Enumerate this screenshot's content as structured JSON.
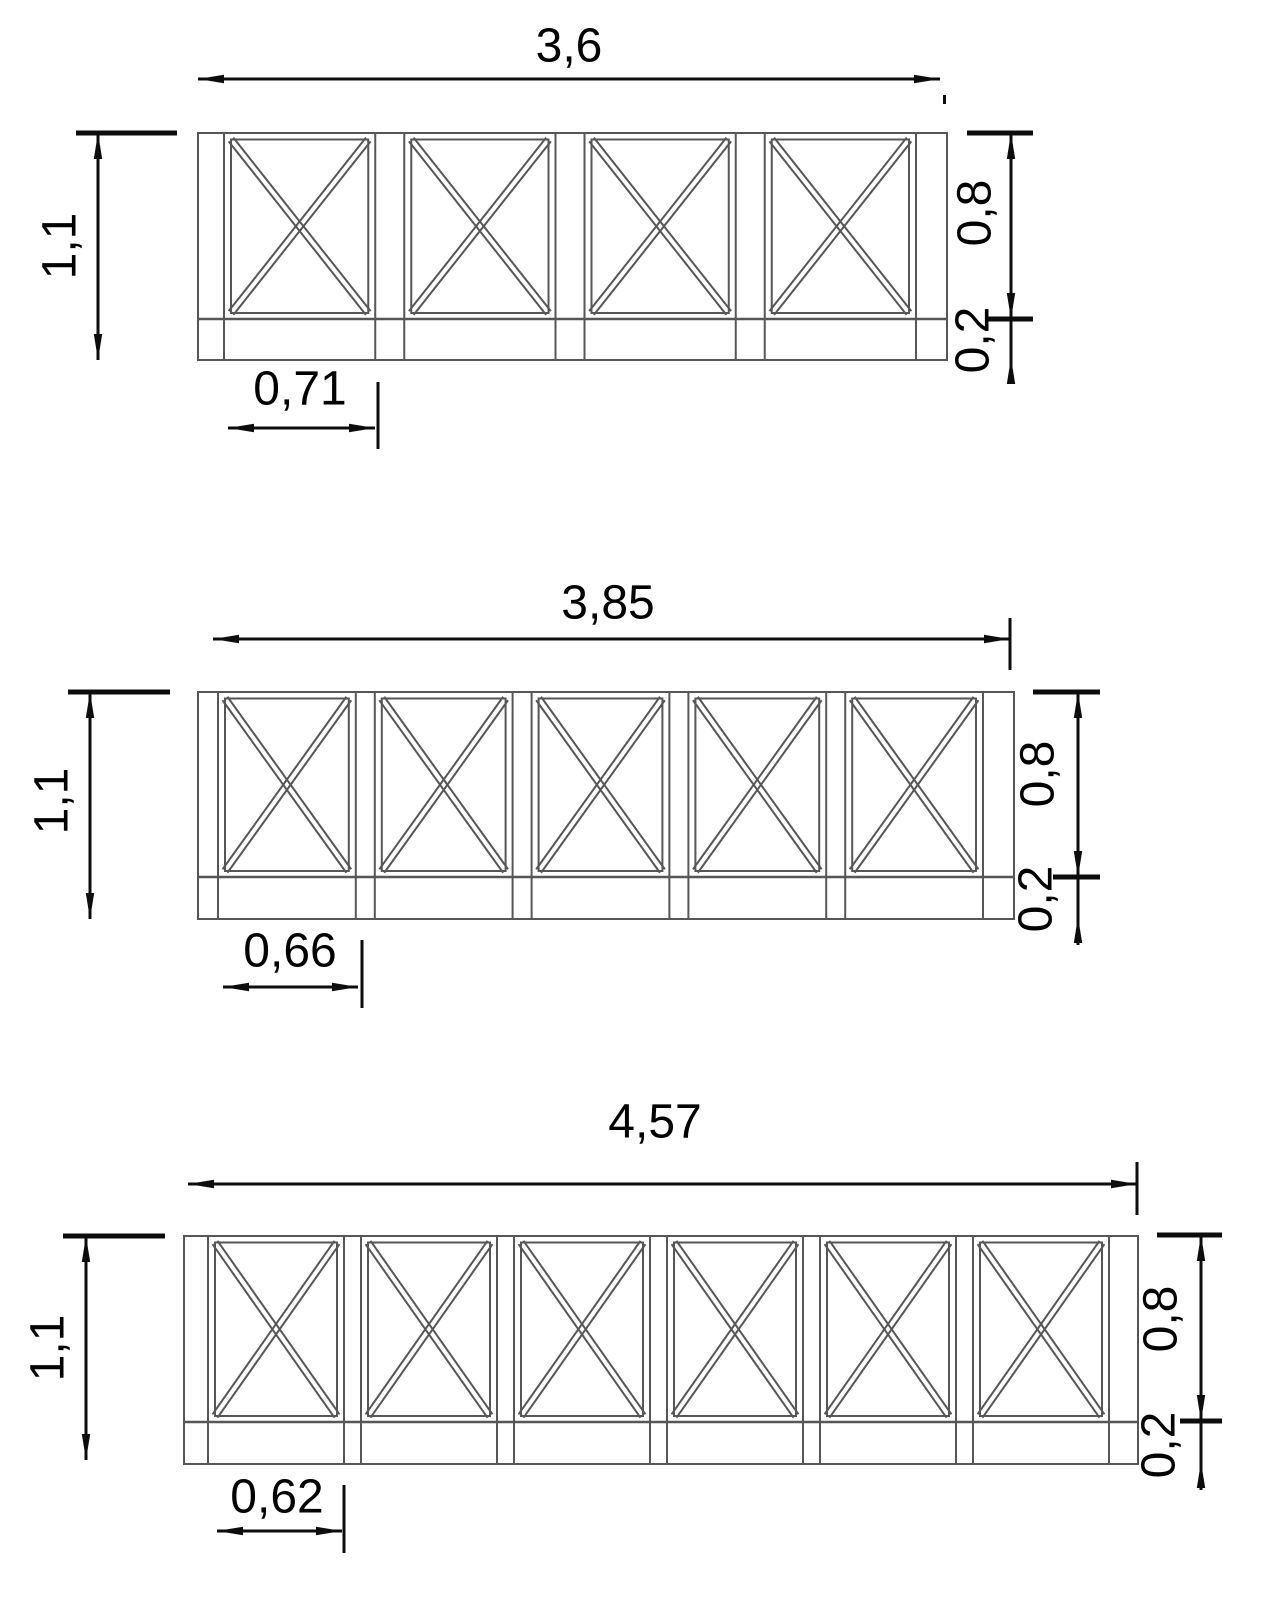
{
  "page": {
    "background": "#ffffff",
    "structure_color": "#565656",
    "dim_color": "#0d0d0d",
    "description": "Three railing elevation drawings with X-braced panels and dimensions"
  },
  "drawings": [
    {
      "id": "top",
      "panel_count": 4,
      "labels": {
        "total_width": "3,6",
        "total_height": "1,1",
        "panel_height": "0,8",
        "base_height": "0,2",
        "panel_width": "0,71"
      },
      "structure": {
        "frame": [
          198,
          133,
          947,
          360
        ],
        "rail_y": 319,
        "vlines": [
          198,
          224,
          375.25,
          404.25,
          555.5,
          584.5,
          735.75,
          764.75,
          916,
          947
        ],
        "panels": [
          [
            224,
            375.25
          ],
          [
            404.25,
            555.5
          ],
          [
            584.5,
            735.75
          ],
          [
            764.75,
            916
          ]
        ],
        "inset": {
          "side": 7,
          "top": 6.5,
          "bottom": 6
        },
        "brace_gap": 3
      },
      "dims": {
        "lines": [
          [
            198,
            79,
            940,
            79
          ],
          [
            98,
            133,
            98,
            360
          ],
          [
            1011,
            133,
            1011,
            383
          ],
          [
            228,
            428,
            375,
            428
          ]
        ],
        "ticks": [
          [
            76,
            133,
            177,
            133
          ],
          [
            967,
            133,
            1033,
            133
          ],
          [
            985,
            319,
            1033,
            319
          ]
        ],
        "ext": [
          [
            378,
            382,
            378,
            449
          ]
        ],
        "arrows": [
          [
            198,
            79,
            "left"
          ],
          [
            940,
            79,
            "right"
          ],
          [
            98,
            133,
            "up"
          ],
          [
            98,
            360,
            "down"
          ],
          [
            1011,
            133,
            "up"
          ],
          [
            1011,
            319,
            "down"
          ],
          [
            1011,
            358,
            "up"
          ],
          [
            228,
            428,
            "left"
          ],
          [
            375,
            428,
            "right"
          ]
        ],
        "dashes": [
          [
            943,
            95,
            3,
            9
          ]
        ]
      }
    },
    {
      "id": "middle",
      "panel_count": 5,
      "labels": {
        "total_width": "3,85",
        "total_height": "1,1",
        "panel_height": "0,8",
        "base_height": "0,2",
        "panel_width": "0,66"
      },
      "structure": {
        "frame": [
          198,
          692,
          1014,
          919
        ],
        "rail_y": 877,
        "vlines": [
          198,
          218,
          355.8,
          374.8,
          512.6,
          531.6,
          669.4,
          688.4,
          826.2,
          845.2,
          983,
          1014
        ],
        "panels": [
          [
            218,
            355.8
          ],
          [
            374.8,
            512.6
          ],
          [
            531.6,
            669.4
          ],
          [
            688.4,
            826.2
          ],
          [
            845.2,
            983
          ]
        ],
        "inset": {
          "side": 7,
          "top": 6.5,
          "bottom": 6
        },
        "brace_gap": 3
      },
      "dims": {
        "lines": [
          [
            213,
            639,
            1010,
            639
          ],
          [
            90,
            692,
            90,
            919
          ],
          [
            1078,
            692,
            1078,
            945
          ],
          [
            223,
            987,
            358,
            987
          ]
        ],
        "ticks": [
          [
            68,
            692,
            170,
            692
          ],
          [
            1033,
            692,
            1100,
            692
          ],
          [
            1053,
            877,
            1100,
            877
          ]
        ],
        "ext": [
          [
            1010,
            618,
            1010,
            670
          ],
          [
            362,
            940,
            362,
            1008
          ]
        ],
        "arrows": [
          [
            213,
            639,
            "left"
          ],
          [
            1010,
            639,
            "right"
          ],
          [
            90,
            692,
            "up"
          ],
          [
            90,
            919,
            "down"
          ],
          [
            1078,
            692,
            "up"
          ],
          [
            1078,
            877,
            "down"
          ],
          [
            1078,
            917,
            "up"
          ],
          [
            223,
            987,
            "left"
          ],
          [
            358,
            987,
            "right"
          ]
        ],
        "dashes": []
      }
    },
    {
      "id": "bottom",
      "panel_count": 6,
      "labels": {
        "total_width": "4,57",
        "total_height": "1,1",
        "panel_height": "0,8",
        "base_height": "0,2",
        "panel_width": "0,62"
      },
      "structure": {
        "frame": [
          184,
          1236,
          1138,
          1464
        ],
        "rail_y": 1422,
        "vlines": [
          184,
          208,
          344,
          361,
          497,
          514,
          650,
          667,
          803,
          820,
          956,
          973,
          1109,
          1138
        ],
        "panels": [
          [
            208,
            344
          ],
          [
            361,
            497
          ],
          [
            514,
            650
          ],
          [
            667,
            803
          ],
          [
            820,
            956
          ],
          [
            973,
            1109
          ]
        ],
        "inset": {
          "side": 7,
          "top": 6.5,
          "bottom": 6
        },
        "brace_gap": 3
      },
      "dims": {
        "lines": [
          [
            188,
            1184,
            1137,
            1184
          ],
          [
            86,
            1236,
            86,
            1460
          ],
          [
            1201,
            1235,
            1201,
            1490
          ],
          [
            217,
            1531,
            342,
            1531
          ]
        ],
        "ticks": [
          [
            63,
            1236,
            165,
            1236
          ],
          [
            1157,
            1235,
            1222,
            1235
          ],
          [
            1180,
            1421,
            1222,
            1421
          ]
        ],
        "ext": [
          [
            1137,
            1162,
            1137,
            1215
          ],
          [
            344,
            1485,
            344,
            1553
          ]
        ],
        "arrows": [
          [
            188,
            1184,
            "left"
          ],
          [
            1137,
            1184,
            "right"
          ],
          [
            86,
            1236,
            "up"
          ],
          [
            86,
            1460,
            "down"
          ],
          [
            1201,
            1235,
            "up"
          ],
          [
            1201,
            1421,
            "down"
          ],
          [
            1201,
            1462,
            "up"
          ],
          [
            217,
            1531,
            "left"
          ],
          [
            342,
            1531,
            "right"
          ]
        ],
        "dashes": []
      }
    }
  ]
}
